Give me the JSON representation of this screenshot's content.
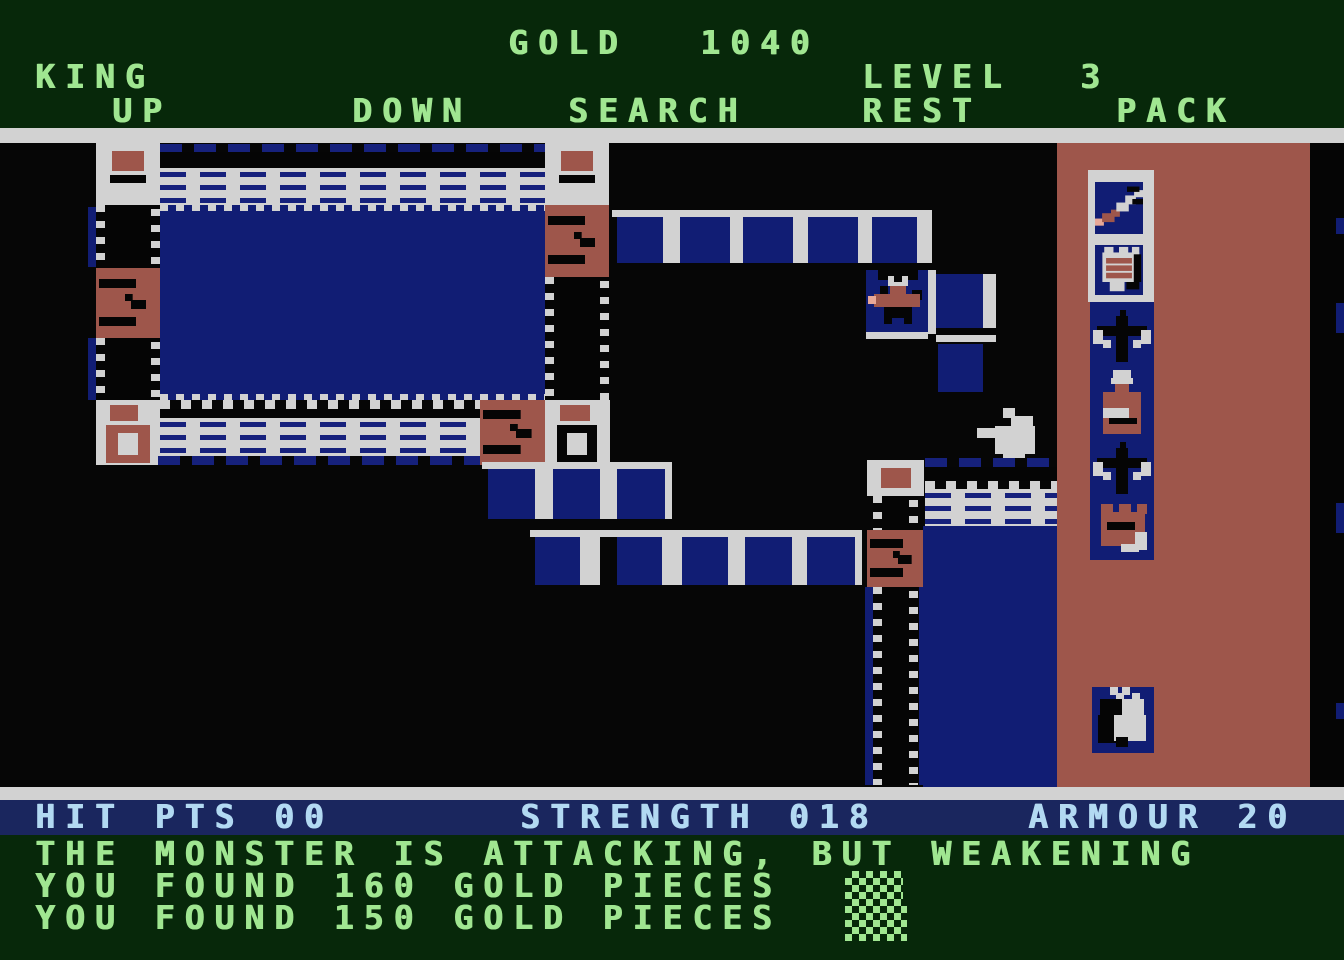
{
  "top_bar": {
    "gold_label": "GOLD",
    "gold_value": "1040",
    "king_label": "KING",
    "level_label": "LEVEL",
    "level_value": "3",
    "commands": {
      "up": "UP",
      "down": "DOWN",
      "search": "SEARCH",
      "rest": "REST",
      "pack": "PACK"
    }
  },
  "status_bar": {
    "hit_points": "HIT PTS 00",
    "strength": "STRENGTH 018",
    "armour": "ARMOUR 20"
  },
  "messages": {
    "line1": "THE MONSTER IS ATTACKING, BUT WEAKENING",
    "line2": "YOU FOUND 160 GOLD PIECES",
    "line3": "YOU FOUND 150 GOLD PIECES"
  },
  "sidebar": {
    "items": [
      {
        "name": "sword"
      },
      {
        "name": "shield-striped"
      },
      {
        "name": "crossbow"
      },
      {
        "name": "potion"
      },
      {
        "name": "crossbow"
      },
      {
        "name": "shield"
      },
      {
        "name": "creature"
      }
    ]
  },
  "map": {
    "player": "adventurer",
    "monster": "white monster"
  },
  "colors": {
    "bar_green_bg": "#07280a",
    "text_green": "#a0e691",
    "status_navy_bg": "#1a265e",
    "text_light_blue": "#b2d9f2",
    "map_navy": "#111d74",
    "wall_gray": "#d2d2d2",
    "door_salmon": "#9e564b",
    "accent_pink": "#e8a898"
  }
}
